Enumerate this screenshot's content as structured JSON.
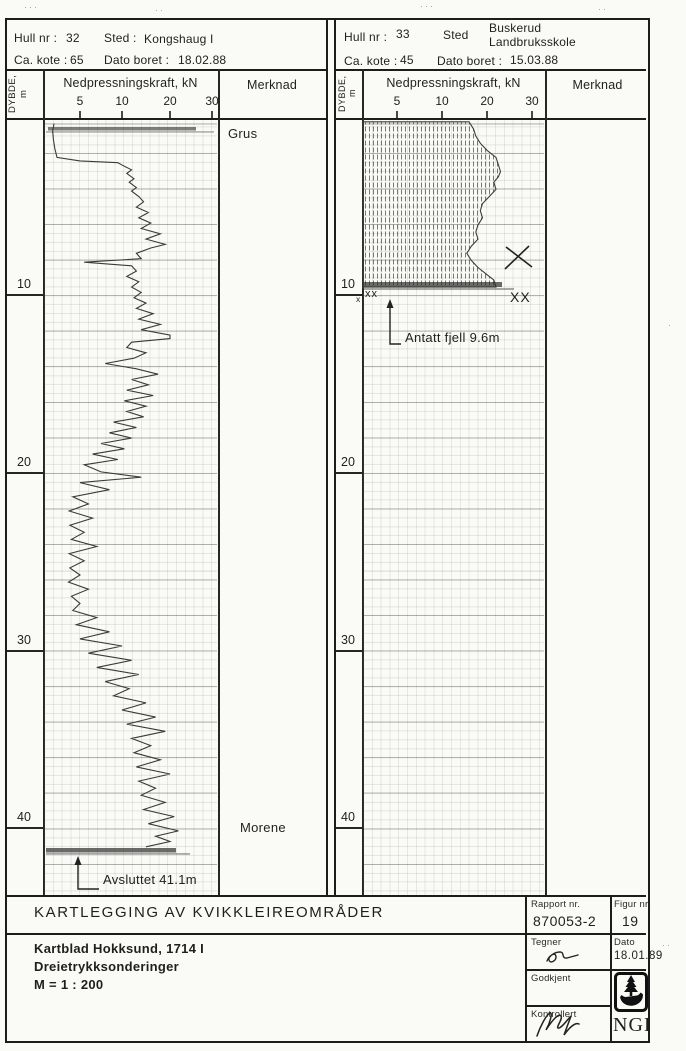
{
  "panels": [
    {
      "header": {
        "hull_label": "Hull nr :",
        "hull_value": "32",
        "sted_label": "Sted :",
        "sted_value": "Kongshaug I",
        "sted_value2": "",
        "kote_label": "Ca. kote :",
        "kote_value": "65",
        "dato_label": "Dato boret :",
        "dato_value": "18.02.88"
      },
      "col_depth": "DYBDE, m",
      "col_force": "Nedpressningskraft, kN",
      "col_merknad": "Merknad",
      "force_ticks": [
        "5",
        "10",
        "20",
        "30"
      ],
      "depth_labels": [
        "10",
        "20",
        "30",
        "40"
      ],
      "notes": [
        {
          "text": "Grus"
        },
        {
          "text": "Morene"
        }
      ],
      "end_note": "Avsluttet 41.1m"
    },
    {
      "header": {
        "hull_label": "Hull nr :",
        "hull_value": "33",
        "sted_label": "Sted",
        "sted_value": "Buskerud",
        "sted_value2": "Landbruksskole",
        "kote_label": "Ca. kote :",
        "kote_value": "45",
        "dato_label": "Dato boret :",
        "dato_value": "15.03.88"
      },
      "col_depth": "DYBDE, m",
      "col_force": "Nedpressningskraft, kN",
      "col_merknad": "Merknad",
      "force_ticks": [
        "5",
        "10",
        "20",
        "30"
      ],
      "depth_labels": [
        "10",
        "20",
        "30",
        "40"
      ],
      "notes": [],
      "end_note": "Antatt fjell 9.6m",
      "marks": {
        "small_x": "x",
        "double_x": "xx",
        "big_x": "XX"
      }
    }
  ],
  "title_block": {
    "title": "KARTLEGGING AV KVIKKLEIREOMRÅDER",
    "line1": "Kartblad Hokksund, 1714 I",
    "line2": "Dreietrykksonderinger",
    "line3": "M = 1 : 200",
    "rapport_label": "Rapport nr.",
    "rapport_value": "870053-2",
    "figur_label": "Figur nr.",
    "figur_value": "19",
    "tegner_label": "Tegner",
    "dato_label": "Dato",
    "dato_value": "18.01.89",
    "godkjent_label": "Godkjent",
    "kontrollert_label": "Kontrollert",
    "logo_text": "NGI"
  },
  "chart_data": [
    {
      "type": "line",
      "name": "Hull nr 32 Kongshaug I - dreietrykksondering",
      "xlabel": "Nedpressningskraft, kN",
      "ylabel": "Dybde, m",
      "x_ticks": [
        5,
        10,
        20,
        30
      ],
      "depth_range": [
        0,
        41.1
      ],
      "annotations": [
        "Grus (topp)",
        "Morene (ca. 40 m)",
        "Avsluttet 41.1m"
      ],
      "points": [
        [
          0.4,
          1.4
        ],
        [
          0.8,
          1.2
        ],
        [
          1.3,
          1.3
        ],
        [
          1.8,
          1.5
        ],
        [
          2.3,
          1.8
        ],
        [
          2.5,
          5
        ],
        [
          2.6,
          9.5
        ],
        [
          2.8,
          10.5
        ],
        [
          3.0,
          12
        ],
        [
          3.2,
          11
        ],
        [
          3.5,
          12.5
        ],
        [
          3.7,
          11.5
        ],
        [
          4.0,
          13
        ],
        [
          4.2,
          12
        ],
        [
          4.5,
          13.5
        ],
        [
          4.8,
          14.5
        ],
        [
          5.1,
          13
        ],
        [
          5.4,
          15.5
        ],
        [
          5.7,
          13.5
        ],
        [
          6.0,
          16
        ],
        [
          6.3,
          14
        ],
        [
          6.6,
          18
        ],
        [
          6.9,
          15
        ],
        [
          7.2,
          19
        ],
        [
          7.4,
          16
        ],
        [
          7.7,
          13
        ],
        [
          8.0,
          14
        ],
        [
          8.2,
          5.5
        ],
        [
          8.4,
          12
        ],
        [
          8.7,
          13
        ],
        [
          9.0,
          11
        ],
        [
          9.3,
          13.5
        ],
        [
          9.6,
          12
        ],
        [
          9.9,
          14
        ],
        [
          10.2,
          12.5
        ],
        [
          10.5,
          15
        ],
        [
          10.8,
          13
        ],
        [
          11.1,
          16.5
        ],
        [
          11.4,
          13.5
        ],
        [
          11.7,
          18
        ],
        [
          12.0,
          14
        ],
        [
          12.3,
          20
        ],
        [
          12.5,
          20
        ],
        [
          12.7,
          12
        ],
        [
          13.0,
          11
        ],
        [
          13.3,
          15
        ],
        [
          13.6,
          12.5
        ],
        [
          13.9,
          8
        ],
        [
          14.2,
          13
        ],
        [
          14.5,
          17.5
        ],
        [
          14.8,
          12
        ],
        [
          15.1,
          15.5
        ],
        [
          15.4,
          11
        ],
        [
          15.7,
          16.5
        ],
        [
          16.0,
          10.5
        ],
        [
          16.3,
          15
        ],
        [
          16.6,
          11
        ],
        [
          16.9,
          14.5
        ],
        [
          17.2,
          9
        ],
        [
          17.5,
          13
        ],
        [
          17.8,
          8.5
        ],
        [
          18.1,
          12
        ],
        [
          18.4,
          7.5
        ],
        [
          18.7,
          10.5
        ],
        [
          19.0,
          6.5
        ],
        [
          19.3,
          9.5
        ],
        [
          19.6,
          5.5
        ],
        [
          20.0,
          7.5
        ],
        [
          20.3,
          14
        ],
        [
          20.6,
          5
        ],
        [
          21.0,
          8.5
        ],
        [
          21.4,
          4
        ],
        [
          21.8,
          6
        ],
        [
          22.2,
          3.5
        ],
        [
          22.6,
          6.5
        ],
        [
          23.0,
          3.6
        ],
        [
          23.4,
          5.5
        ],
        [
          23.8,
          3.8
        ],
        [
          24.2,
          7
        ],
        [
          24.6,
          3.5
        ],
        [
          25.0,
          5.5
        ],
        [
          25.4,
          3.6
        ],
        [
          25.8,
          5
        ],
        [
          26.2,
          3.4
        ],
        [
          26.6,
          6
        ],
        [
          27.0,
          3.8
        ],
        [
          27.4,
          5
        ],
        [
          27.8,
          4
        ],
        [
          28.2,
          7
        ],
        [
          28.6,
          4.5
        ],
        [
          29.0,
          8.5
        ],
        [
          29.4,
          5
        ],
        [
          29.8,
          10
        ],
        [
          30.2,
          6
        ],
        [
          30.6,
          12
        ],
        [
          31.0,
          7
        ],
        [
          31.4,
          13.5
        ],
        [
          31.8,
          8
        ],
        [
          32.2,
          11.5
        ],
        [
          32.6,
          9
        ],
        [
          33.0,
          15
        ],
        [
          33.4,
          10
        ],
        [
          33.8,
          17
        ],
        [
          34.2,
          11
        ],
        [
          34.6,
          19
        ],
        [
          35.0,
          12
        ],
        [
          35.4,
          16
        ],
        [
          35.8,
          12.5
        ],
        [
          36.2,
          18
        ],
        [
          36.6,
          13
        ],
        [
          37.0,
          20
        ],
        [
          37.4,
          13.5
        ],
        [
          37.8,
          17
        ],
        [
          38.2,
          14
        ],
        [
          38.6,
          19
        ],
        [
          39.0,
          14.5
        ],
        [
          39.4,
          21
        ],
        [
          39.8,
          15.5
        ],
        [
          40.2,
          22
        ],
        [
          40.5,
          17
        ],
        [
          40.8,
          20
        ],
        [
          41.1,
          15
        ]
      ]
    },
    {
      "type": "area",
      "name": "Hull nr 33 Buskerud Landbruksskole - dreietrykksondering",
      "xlabel": "Nedpressningskraft, kN",
      "ylabel": "Dybde, m",
      "x_ticks": [
        5,
        10,
        20,
        30
      ],
      "depth_range": [
        0,
        9.6
      ],
      "annotations": [
        "Antatt fjell 9.6m"
      ],
      "points": [
        [
          0.3,
          16
        ],
        [
          0.7,
          17
        ],
        [
          1.1,
          17.5
        ],
        [
          1.5,
          18.5
        ],
        [
          1.9,
          20
        ],
        [
          2.3,
          22
        ],
        [
          2.7,
          22.5
        ],
        [
          3.1,
          23
        ],
        [
          3.4,
          22.5
        ],
        [
          3.7,
          21.5
        ],
        [
          4.1,
          22
        ],
        [
          4.5,
          20.5
        ],
        [
          4.9,
          19
        ],
        [
          5.3,
          18.5
        ],
        [
          5.7,
          19
        ],
        [
          6.1,
          18
        ],
        [
          6.5,
          17.5
        ],
        [
          6.9,
          18
        ],
        [
          7.3,
          16.5
        ],
        [
          7.7,
          15.5
        ],
        [
          8.1,
          16.5
        ],
        [
          8.5,
          18
        ],
        [
          8.9,
          20
        ],
        [
          9.2,
          21.5
        ],
        [
          9.6,
          22
        ]
      ]
    }
  ]
}
